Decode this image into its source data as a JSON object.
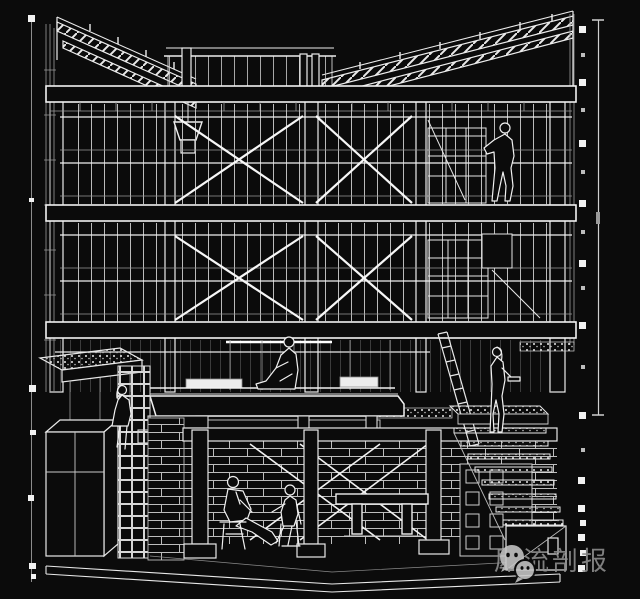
{
  "colors": {
    "background": "#0b0b0b",
    "line": "#f2f2f2",
    "dim_line": "#9a9a9a",
    "watermark_text": "#8f8f8f",
    "watermark_icon": "#c6c6c6"
  },
  "watermark": {
    "label": "犀流剖报",
    "icon": "wechat-logo-icon"
  }
}
